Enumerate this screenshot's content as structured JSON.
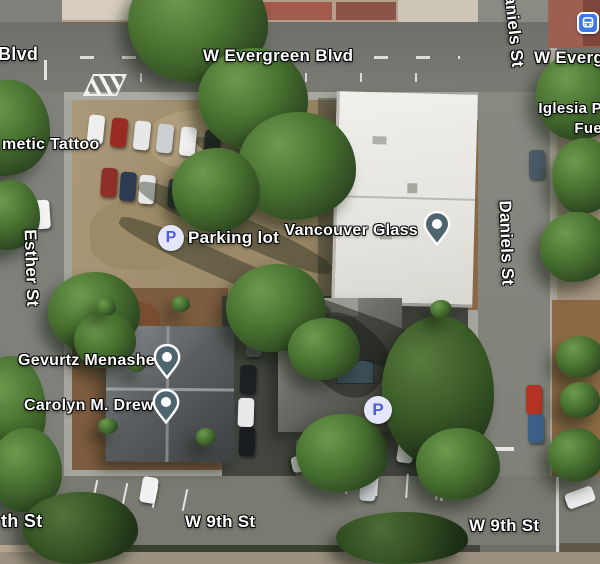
{
  "map": {
    "road_labels": {
      "blvd_partial": "Blvd",
      "evergreen": "W Evergreen Blvd",
      "daniels": "Daniels St",
      "esther": "Esther St",
      "ninth": "W 9th St",
      "ninth_partial": "th St"
    },
    "poi_labels": {
      "tattoo_partial": "metic Tattoo",
      "parking_lot": "Parking lot",
      "vancouver_glass": "Vancouver Glass",
      "gevurtz_menashe": "Gevurtz Menashe",
      "carolyn_drew": "Carolyn M. Drew",
      "iglesia_line1": "Iglesia P",
      "iglesia_line2": "Fue"
    },
    "icons": {
      "parking_letter": "P"
    },
    "colors": {
      "pin_fill": "#4e6570",
      "parking_letter_blue": "#4d5ed4",
      "parking_circle_bg": "#e4e7fb",
      "transit_blue": "#3c78e8",
      "label_text": "#ffffff"
    }
  }
}
